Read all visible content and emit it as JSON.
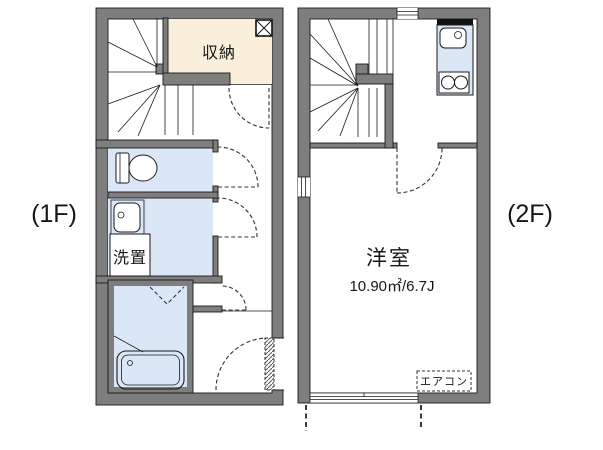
{
  "floor1": {
    "label": "(1F)",
    "rooms": {
      "storage": "収納",
      "laundry": "洗置"
    }
  },
  "floor2": {
    "label": "(2F)",
    "rooms": {
      "western_room": "洋室",
      "western_room_area": "10.90㎡/6.7J",
      "aircon": "エアコン"
    }
  },
  "colors": {
    "wall": "#7e7e7e",
    "storage_fill": "#f9efda",
    "water_fill": "#dbe7f6"
  }
}
